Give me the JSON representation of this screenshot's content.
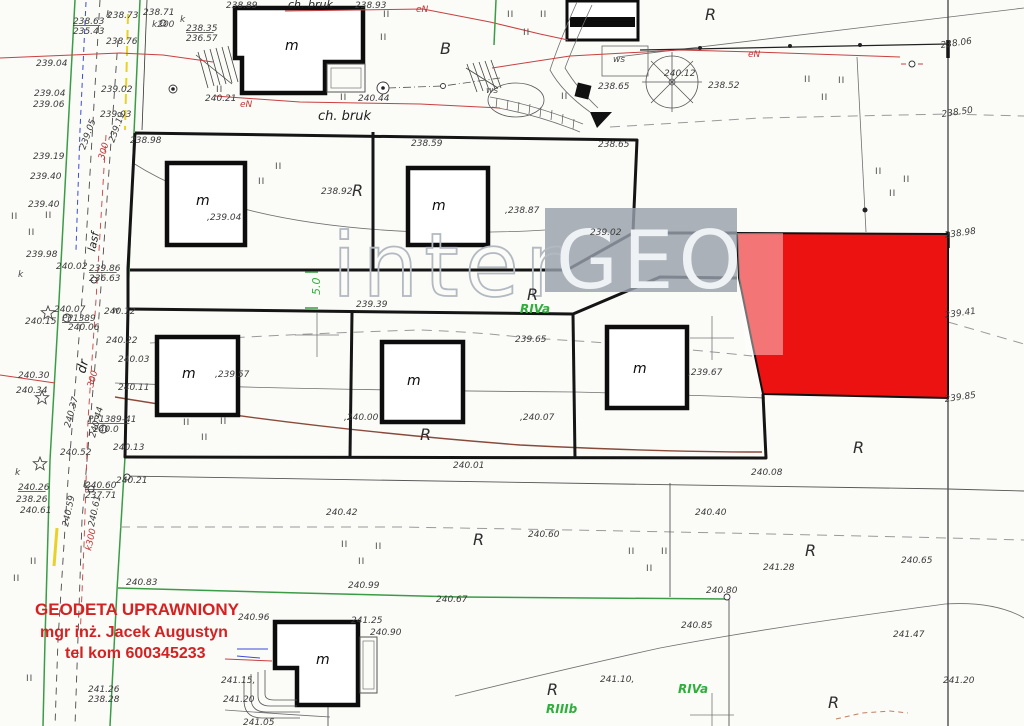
{
  "map": {
    "watermark": {
      "inter": "inter",
      "geo": "GEO"
    },
    "stamp": {
      "line1": "GEODETA UPRAWNIONY",
      "line2": "mgr  inż.  Jacek Augustyn",
      "line3": "tel kom 600345233",
      "color": "#d32222"
    },
    "highlight_color": "#ec1212",
    "building_label": "m",
    "labels": [
      {
        "t": "238.73",
        "x": 107,
        "y": 18
      },
      {
        "t": "238.71",
        "x": 143,
        "y": 15
      },
      {
        "t": "k200",
        "x": 152,
        "y": 27,
        "c": "ws"
      },
      {
        "t": "238.63",
        "x": 73,
        "y": 24,
        "u": 1
      },
      {
        "t": "235.43",
        "x": 73,
        "y": 34
      },
      {
        "t": "238.76",
        "x": 106,
        "y": 44
      },
      {
        "t": "238.35",
        "x": 186,
        "y": 31,
        "u": 1
      },
      {
        "t": "236.57",
        "x": 186,
        "y": 41
      },
      {
        "t": "239.04",
        "x": 36,
        "y": 66
      },
      {
        "t": "239.02",
        "x": 101,
        "y": 92
      },
      {
        "t": "239.04",
        "x": 34,
        "y": 96
      },
      {
        "t": "239.06",
        "x": 33,
        "y": 107
      },
      {
        "t": "239.03",
        "x": 100,
        "y": 117
      },
      {
        "t": "239.19",
        "x": 33,
        "y": 159
      },
      {
        "t": "239.40",
        "x": 30,
        "y": 179
      },
      {
        "t": "239.40",
        "x": 28,
        "y": 207
      },
      {
        "t": "239.05",
        "x": 85,
        "y": 150,
        "r": -70
      },
      {
        "t": "239.19",
        "x": 114,
        "y": 143,
        "r": -70
      },
      {
        "t": "300",
        "x": 104,
        "y": 160,
        "r": -75,
        "c": "rd"
      },
      {
        "t": "lasf",
        "x": 95,
        "y": 252,
        "r": -78,
        "c": "pa"
      },
      {
        "t": "239.98",
        "x": 26,
        "y": 257
      },
      {
        "t": "240.02",
        "x": 56,
        "y": 269
      },
      {
        "t": "239.86",
        "x": 89,
        "y": 271,
        "u": 1
      },
      {
        "t": "236.63",
        "x": 89,
        "y": 281
      },
      {
        "t": "240.07",
        "x": 54,
        "y": 312
      },
      {
        "t": "PP1389",
        "x": 62,
        "y": 321,
        "u": 1
      },
      {
        "t": "240.06",
        "x": 68,
        "y": 330
      },
      {
        "t": "240.12",
        "x": 104,
        "y": 314
      },
      {
        "t": "240.15",
        "x": 25,
        "y": 324
      },
      {
        "t": "238.89",
        "x": 226,
        "y": 8
      },
      {
        "t": "ch. bruk",
        "x": 288,
        "y": 8,
        "c": "pa"
      },
      {
        "t": "238.93",
        "x": 355,
        "y": 8
      },
      {
        "t": "240.21",
        "x": 205,
        "y": 101
      },
      {
        "t": "240.44",
        "x": 358,
        "y": 101
      },
      {
        "t": "ch. bruk",
        "x": 318,
        "y": 120,
        "c": "pa2"
      },
      {
        "t": "B",
        "x": 440,
        "y": 54,
        "c": "big"
      },
      {
        "t": "ws",
        "x": 486,
        "y": 93,
        "c": "ws"
      },
      {
        "t": "ws",
        "x": 613,
        "y": 62,
        "c": "ws"
      },
      {
        "t": "238.65",
        "x": 598,
        "y": 89
      },
      {
        "t": "240.12",
        "x": 664,
        "y": 76
      },
      {
        "t": "238.52",
        "x": 708,
        "y": 88
      },
      {
        "t": "R",
        "x": 705,
        "y": 20,
        "c": "big"
      },
      {
        "t": "238.06",
        "x": 941,
        "y": 48,
        "r": -8
      },
      {
        "t": "238.50",
        "x": 942,
        "y": 117,
        "r": -8
      },
      {
        "t": "eN",
        "x": 416,
        "y": 12,
        "c": "rd"
      },
      {
        "t": "eN",
        "x": 240,
        "y": 107,
        "c": "rd"
      },
      {
        "t": "eN",
        "x": 748,
        "y": 57,
        "c": "rd"
      },
      {
        "t": "238.98",
        "x": 130,
        "y": 143
      },
      {
        "t": "238.59",
        "x": 411,
        "y": 146
      },
      {
        "t": "238.65",
        "x": 598,
        "y": 147
      },
      {
        "t": "238.92",
        "x": 321,
        "y": 194
      },
      {
        "t": "R",
        "x": 352,
        "y": 196,
        "c": "big"
      },
      {
        "t": ",239.04",
        "x": 207,
        "y": 220
      },
      {
        "t": ",238.87",
        "x": 505,
        "y": 213
      },
      {
        "t": "239.02",
        "x": 590,
        "y": 235
      },
      {
        "t": "238.98",
        "x": 945,
        "y": 238,
        "r": -8
      },
      {
        "t": "239.41",
        "x": 945,
        "y": 318,
        "r": -8
      },
      {
        "t": "239.85",
        "x": 945,
        "y": 402,
        "r": -8
      },
      {
        "t": "5.0",
        "x": 320,
        "y": 295,
        "r": -90,
        "c": "g2"
      },
      {
        "t": "239.39",
        "x": 356,
        "y": 307
      },
      {
        "t": "R",
        "x": 527,
        "y": 300,
        "c": "big"
      },
      {
        "t": "RIVa",
        "x": 520,
        "y": 313,
        "c": "g"
      },
      {
        "t": "239.65",
        "x": 515,
        "y": 342
      },
      {
        "t": "240.22",
        "x": 106,
        "y": 343
      },
      {
        "t": "240.03",
        "x": 118,
        "y": 362
      },
      {
        "t": "240.11",
        "x": 118,
        "y": 390
      },
      {
        "t": ",239.57",
        "x": 215,
        "y": 377
      },
      {
        "t": "PP1389-41",
        "x": 88,
        "y": 422,
        "u": 1
      },
      {
        "t": "240.0",
        "x": 93,
        "y": 432
      },
      {
        "t": "240.13",
        "x": 113,
        "y": 450
      },
      {
        "t": "240.52",
        "x": 60,
        "y": 455
      },
      {
        "t": ",240.00",
        "x": 344,
        "y": 420
      },
      {
        "t": "R",
        "x": 420,
        "y": 440,
        "c": "big"
      },
      {
        "t": ",240.07",
        "x": 520,
        "y": 420
      },
      {
        "t": ",239.67",
        "x": 688,
        "y": 375
      },
      {
        "t": "240.01",
        "x": 453,
        "y": 468
      },
      {
        "t": "240.08",
        "x": 751,
        "y": 475
      },
      {
        "t": "240.21",
        "x": 116,
        "y": 483
      },
      {
        "t": "240.30",
        "x": 18,
        "y": 378
      },
      {
        "t": "240.34",
        "x": 16,
        "y": 393
      },
      {
        "t": "dr",
        "x": 85,
        "y": 374,
        "r": -75,
        "c": "pa2"
      },
      {
        "t": "240.37",
        "x": 70,
        "y": 428,
        "r": -75
      },
      {
        "t": "240.44",
        "x": 95,
        "y": 438,
        "r": -75
      },
      {
        "t": "300",
        "x": 93,
        "y": 388,
        "r": -75,
        "c": "rd"
      },
      {
        "t": "k300",
        "x": 91,
        "y": 551,
        "r": -78,
        "c": "rd"
      },
      {
        "t": "240.26",
        "x": 18,
        "y": 490,
        "u": 1
      },
      {
        "t": "238.26",
        "x": 16,
        "y": 502
      },
      {
        "t": "240.61",
        "x": 20,
        "y": 513
      },
      {
        "t": "240.60",
        "x": 85,
        "y": 488,
        "u": 1
      },
      {
        "t": "237.71",
        "x": 85,
        "y": 498
      },
      {
        "t": "240.59",
        "x": 68,
        "y": 527,
        "r": -78
      },
      {
        "t": "240.61",
        "x": 94,
        "y": 527,
        "r": -78
      },
      {
        "t": "240.42",
        "x": 326,
        "y": 515
      },
      {
        "t": "R",
        "x": 473,
        "y": 545,
        "c": "big"
      },
      {
        "t": "240.60",
        "x": 528,
        "y": 537
      },
      {
        "t": "240.83",
        "x": 126,
        "y": 585
      },
      {
        "t": "240.99",
        "x": 348,
        "y": 588
      },
      {
        "t": "240.67",
        "x": 436,
        "y": 602
      },
      {
        "t": "240.40",
        "x": 695,
        "y": 515
      },
      {
        "t": "241.28",
        "x": 763,
        "y": 570
      },
      {
        "t": "R",
        "x": 805,
        "y": 556,
        "c": "big"
      },
      {
        "t": "240.65",
        "x": 901,
        "y": 563
      },
      {
        "t": "240.80",
        "x": 706,
        "y": 593
      },
      {
        "t": "R",
        "x": 853,
        "y": 453,
        "c": "big"
      },
      {
        "t": "240.96",
        "x": 238,
        "y": 620
      },
      {
        "t": "241.25",
        "x": 351,
        "y": 623
      },
      {
        "t": "240.90",
        "x": 370,
        "y": 635
      },
      {
        "t": "241.15,",
        "x": 221,
        "y": 683
      },
      {
        "t": "241.20",
        "x": 223,
        "y": 702
      },
      {
        "t": "241.05",
        "x": 243,
        "y": 725
      },
      {
        "t": "240.85",
        "x": 681,
        "y": 628
      },
      {
        "t": "241.10,",
        "x": 600,
        "y": 682
      },
      {
        "t": "R",
        "x": 547,
        "y": 695,
        "c": "big"
      },
      {
        "t": "RIIIb",
        "x": 546,
        "y": 713,
        "c": "g"
      },
      {
        "t": "RIVa",
        "x": 678,
        "y": 693,
        "c": "g"
      },
      {
        "t": "241.47",
        "x": 893,
        "y": 637
      },
      {
        "t": "241.20",
        "x": 943,
        "y": 683
      },
      {
        "t": "R",
        "x": 828,
        "y": 708,
        "c": "big"
      },
      {
        "t": "241.26",
        "x": 88,
        "y": 692
      },
      {
        "t": "238.28",
        "x": 88,
        "y": 702
      },
      {
        "t": "k",
        "x": 106,
        "y": 17,
        "c": "ws"
      },
      {
        "t": "k",
        "x": 180,
        "y": 22,
        "c": "ws"
      },
      {
        "t": "k",
        "x": 18,
        "y": 277,
        "c": "ws"
      },
      {
        "t": "k",
        "x": 15,
        "y": 475,
        "c": "ws"
      },
      {
        "t": "k",
        "x": 83,
        "y": 487,
        "c": "ws"
      },
      {
        "t": "w",
        "x": 112,
        "y": 313,
        "c": "ws"
      },
      {
        "t": "m",
        "x": 285,
        "y": 50,
        "c": "m"
      },
      {
        "t": "m",
        "x": 196,
        "y": 205,
        "c": "m"
      },
      {
        "t": "m",
        "x": 432,
        "y": 210,
        "c": "m"
      },
      {
        "t": "m",
        "x": 182,
        "y": 378,
        "c": "m"
      },
      {
        "t": "m",
        "x": 407,
        "y": 385,
        "c": "m"
      },
      {
        "t": "m",
        "x": 633,
        "y": 373,
        "c": "m"
      },
      {
        "t": "m",
        "x": 316,
        "y": 664,
        "c": "m"
      }
    ],
    "veg_marks": [
      [
        507,
        17
      ],
      [
        540,
        17
      ],
      [
        523,
        35
      ],
      [
        561,
        99
      ],
      [
        383,
        17
      ],
      [
        380,
        40
      ],
      [
        340,
        100
      ],
      [
        216,
        92
      ],
      [
        275,
        169
      ],
      [
        258,
        184
      ],
      [
        804,
        82
      ],
      [
        838,
        83
      ],
      [
        821,
        100
      ],
      [
        875,
        174
      ],
      [
        903,
        182
      ],
      [
        889,
        196
      ],
      [
        11,
        219
      ],
      [
        45,
        218
      ],
      [
        28,
        235
      ],
      [
        183,
        425
      ],
      [
        220,
        424
      ],
      [
        201,
        440
      ],
      [
        341,
        547
      ],
      [
        375,
        549
      ],
      [
        358,
        564
      ],
      [
        628,
        554
      ],
      [
        661,
        554
      ],
      [
        646,
        571
      ],
      [
        30,
        564
      ],
      [
        13,
        581
      ],
      [
        26,
        681
      ]
    ],
    "tree_stars": [
      [
        48,
        313
      ],
      [
        42,
        398
      ],
      [
        40,
        464
      ]
    ],
    "grid_crosses": [
      [
        317,
        335
      ],
      [
        712,
        338
      ],
      [
        712,
        715
      ]
    ],
    "point_circles": [
      {
        "x": 67,
        "y": 318,
        "r": 4
      },
      {
        "x": 103,
        "y": 429,
        "r": 4
      },
      {
        "x": 94,
        "y": 280,
        "r": 3
      },
      {
        "x": 91,
        "y": 489,
        "r": 3
      },
      {
        "x": 163,
        "y": 23,
        "r": 3
      },
      {
        "x": 173,
        "y": 89,
        "r": 4,
        "d": 1
      },
      {
        "x": 383,
        "y": 88,
        "r": 6,
        "d": 1
      },
      {
        "x": 443,
        "y": 86,
        "r": 2.5
      },
      {
        "x": 727,
        "y": 597,
        "r": 3
      },
      {
        "x": 127,
        "y": 477,
        "r": 3
      },
      {
        "x": 912,
        "y": 64,
        "r": 3
      },
      {
        "x": 700,
        "y": 48,
        "r": 2,
        "f": 1
      },
      {
        "x": 790,
        "y": 46,
        "r": 2,
        "f": 1
      },
      {
        "x": 860,
        "y": 45,
        "r": 2,
        "f": 1
      },
      {
        "x": 865,
        "y": 210,
        "r": 2.5,
        "f": 1
      }
    ]
  }
}
